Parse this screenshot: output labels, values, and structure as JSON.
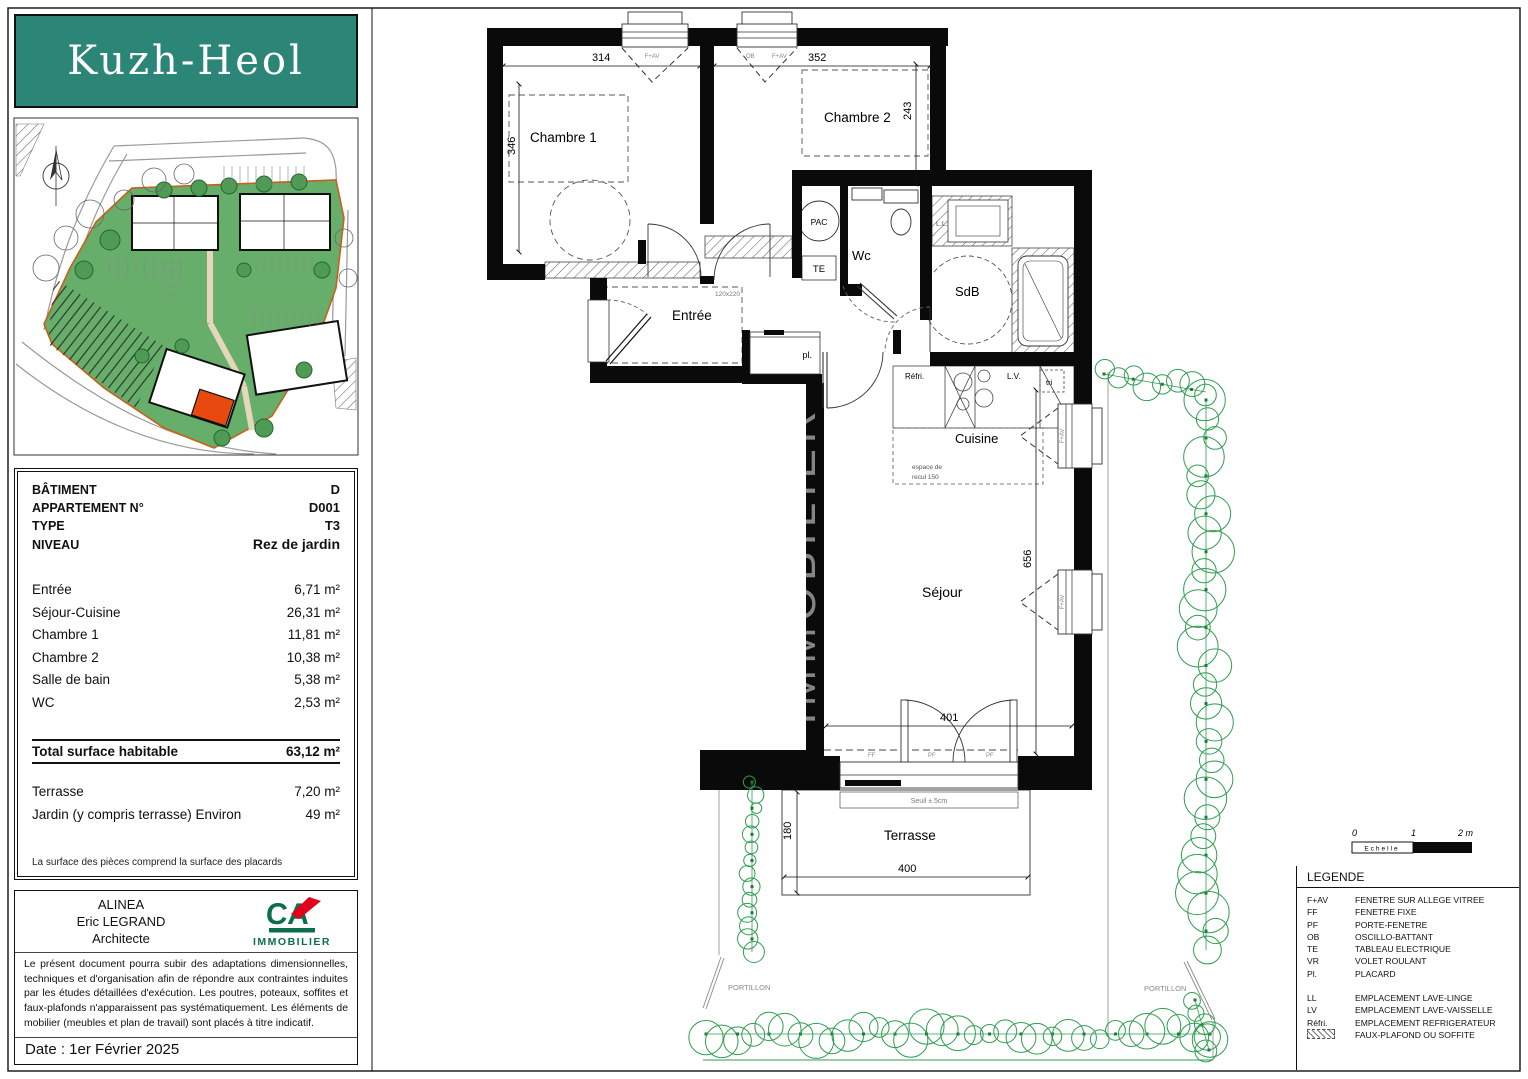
{
  "logo": {
    "title": "Kuzh-Heol",
    "bg_color": "#2b8677"
  },
  "info_panel": {
    "header_rows": [
      {
        "label": "BÂTIMENT",
        "value": "D",
        "big": false
      },
      {
        "label": "APPARTEMENT N°",
        "value": "D001",
        "big": false
      },
      {
        "label": "TYPE",
        "value": "T3",
        "big": false
      },
      {
        "label": "NIVEAU",
        "value": "Rez de jardin",
        "big": true
      }
    ],
    "room_rows": [
      {
        "label": "Entrée",
        "value": "6,71 m²"
      },
      {
        "label": "Séjour-Cuisine",
        "value": "26,31 m²"
      },
      {
        "label": "Chambre 1",
        "value": "11,81 m²"
      },
      {
        "label": "Chambre 2",
        "value": "10,38 m²"
      },
      {
        "label": "Salle de bain",
        "value": "5,38 m²"
      },
      {
        "label": "WC",
        "value": "2,53 m²"
      }
    ],
    "total_row": {
      "label": "Total surface habitable",
      "value": "63,12 m²"
    },
    "extra_rows": [
      {
        "label": "Terrasse",
        "value": "7,20 m²"
      },
      {
        "label": "Jardin (y compris terrasse) Environ",
        "value": "49 m²"
      }
    ],
    "note": "La surface des pièces comprend la surface des placards"
  },
  "architect_panel": {
    "firm": "ALINEA",
    "name": "Eric LEGRAND",
    "role": "Architecte",
    "brand": "IMMOBILIER",
    "disclaimer": "Le présent document pourra subir des adaptations dimensionnelles, techniques et d'organisation afin de répondre aux contraintes induites par les études détaillées d'exécution. Les poutres, poteaux, soffites et faux-plafonds n'apparaissent pas systématiquement. Les éléments de mobilier (meubles et plan de travail) sont placés à titre indicatif.",
    "date": "Date : 1er Février 2025"
  },
  "plan": {
    "rooms": {
      "chambre1": "Chambre 1",
      "chambre2": "Chambre 2",
      "wc": "Wc",
      "sdb": "SdB",
      "entree": "Entrée",
      "cuisine": "Cuisine",
      "sejour": "Séjour",
      "terrasse": "Terrasse"
    },
    "labels": {
      "pac": "PAC",
      "te": "TE",
      "pl": "pl.",
      "refri": "Réfri.",
      "lv": "L.V.",
      "ll": "L.L.",
      "tri": "tri",
      "espace1": "espace de",
      "espace2": "recul 150",
      "seuil": "Seuil ± 5cm",
      "door_size": "120x220",
      "portillon_left": "PORTILLON",
      "portillon_right": "PORTILLON",
      "fav1": "F+AV",
      "ob2": "OB",
      "fav2": "F+AV",
      "fav3": "F+AV",
      "fav4": "F+AV",
      "ff_b": "FF",
      "pf_b1": "PF",
      "pf_b2": "PF",
      "watermark": "IMMOBILIER"
    },
    "dimensions": {
      "d314": "314",
      "d352": "352",
      "d346": "346",
      "d243": "243",
      "d656": "656",
      "d401": "401",
      "d400": "400",
      "d180": "180"
    }
  },
  "scalebar": {
    "zero": "0",
    "one": "1",
    "two": "2 m",
    "label": "Echelle"
  },
  "legend": {
    "title": "LEGENDE",
    "group1": [
      {
        "k": "F+AV",
        "v": "FENETRE SUR ALLEGE VITREE"
      },
      {
        "k": "FF",
        "v": "FENETRE FIXE"
      },
      {
        "k": "PF",
        "v": "PORTE-FENETRE"
      },
      {
        "k": "OB",
        "v": "OSCILLO-BATTANT"
      },
      {
        "k": "TE",
        "v": "TABLEAU ELECTRIQUE"
      },
      {
        "k": "VR",
        "v": "VOLET ROULANT"
      },
      {
        "k": "Pl.",
        "v": "PLACARD"
      }
    ],
    "group2": [
      {
        "k": "LL",
        "v": "EMPLACEMENT LAVE-LINGE"
      },
      {
        "k": "LV",
        "v": "EMPLACEMENT LAVE-VAISSELLE"
      },
      {
        "k": "Réfri.",
        "v": "EMPLACEMENT REFRIGERATEUR"
      },
      {
        "k": "@hatch",
        "v": "FAUX-PLAFOND OU SOFFITE"
      }
    ]
  },
  "colors": {
    "logo_teal": "#2b8677",
    "wall_black": "#0a0a0a",
    "hedge_green": "#2f9e4f",
    "site_green": "#68ae6b",
    "unit_red": "#e8490f",
    "ca_green": "#0d6e4b",
    "ca_red": "#e2001a"
  }
}
